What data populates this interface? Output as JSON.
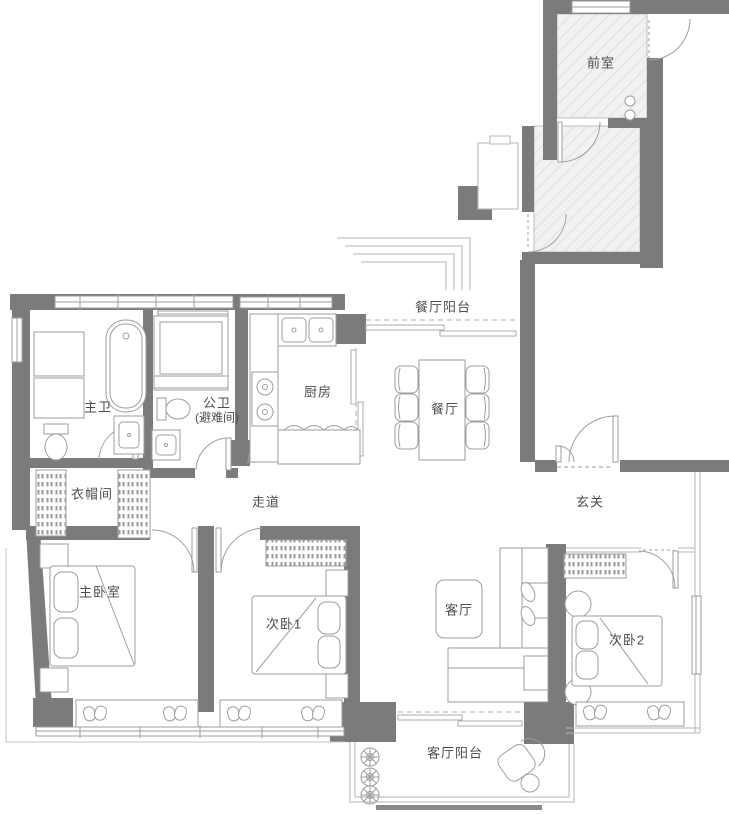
{
  "palette": {
    "wall": "#7b7b7b",
    "line": "#9e9e9e",
    "light_line": "#c4c4c4",
    "hatch_bg": "#f1f1f1",
    "hatch_line": "#d9d9d9",
    "text": "#4d4d4d",
    "background": "#ffffff"
  },
  "rooms": [
    {
      "id": "front-room",
      "label": "前室"
    },
    {
      "id": "dining-balcony",
      "label": "餐厅阳台"
    },
    {
      "id": "master-bath",
      "label": "主卫"
    },
    {
      "id": "public-bath",
      "label": "公卫",
      "label2": "(避难间)"
    },
    {
      "id": "kitchen",
      "label": "厨房"
    },
    {
      "id": "dining-room",
      "label": "餐厅"
    },
    {
      "id": "cloakroom",
      "label": "衣帽间"
    },
    {
      "id": "corridor",
      "label": "走道"
    },
    {
      "id": "foyer",
      "label": "玄关"
    },
    {
      "id": "master-bedroom",
      "label": "主卧室"
    },
    {
      "id": "bedroom-1",
      "label": "次卧1"
    },
    {
      "id": "living-room",
      "label": "客厅"
    },
    {
      "id": "bedroom-2",
      "label": "次卧2"
    },
    {
      "id": "living-balcony",
      "label": "客厅阳台"
    }
  ]
}
